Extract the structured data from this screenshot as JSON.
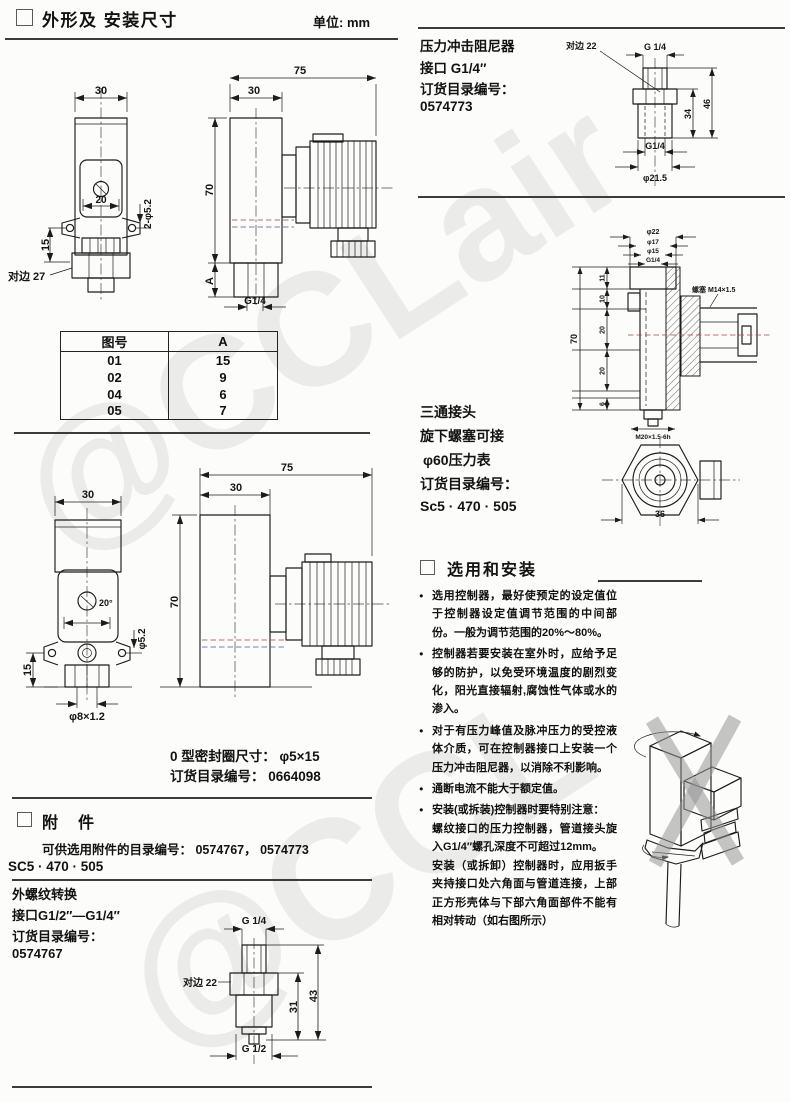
{
  "watermark": {
    "big": "@CCLair",
    "bottom": "@CCL"
  },
  "left": {
    "header": {
      "title": "外形及 安装尺寸",
      "unit": "单位: mm"
    },
    "drawing1": {
      "front": {
        "w30": "30",
        "w20": "20",
        "h15": "15",
        "holes": "2-φ5.2",
        "flats": "对边 27"
      },
      "side": {
        "w75": "75",
        "w30": "30",
        "h70": "70",
        "hA": "A",
        "thread": "G1/4"
      }
    },
    "table": {
      "col_no": "图号",
      "col_a": "A",
      "rows": [
        {
          "no": "01",
          "a": "15"
        },
        {
          "no": "02",
          "a": "9"
        },
        {
          "no": "04",
          "a": "6"
        },
        {
          "no": "05",
          "a": "7"
        }
      ]
    },
    "drawing2": {
      "front": {
        "w30": "30",
        "w20": "20°",
        "h15": "15",
        "hole": "φ5.2",
        "gland": "φ8×1.2"
      },
      "side": {
        "w75": "75",
        "w30": "30",
        "h70": "70"
      }
    },
    "oring": {
      "line1": "0 型密封圈尺寸： φ5×15",
      "line2": "订货目录编号： 0664098"
    },
    "accessories": {
      "title": "附　件",
      "catalog": "可供选用附件的目录编号： 0574767， 0574773",
      "model": "SC5 · 470 · 505",
      "adapter": {
        "line1": "外螺纹转换",
        "line2": "接口G1/2″—G1/4″",
        "line3": "订货目录编号：",
        "line4": "0574767",
        "dims": {
          "top": "G 1/4",
          "flats": "对边 22",
          "h31": "31",
          "h43": "43",
          "bottom": "G 1/2"
        }
      }
    }
  },
  "right": {
    "damper": {
      "line1": "压力冲击阻尼器",
      "line2": "接口 G1/4″",
      "line3": "订货目录编号：",
      "line4": "0574773",
      "dims": {
        "flats": "对边 22",
        "top": "G 1/4",
        "h34": "34",
        "h46": "46",
        "thread": "G1/4",
        "dia": "φ21.5"
      }
    },
    "tee": {
      "line1": "三通接头",
      "line2": "旋下螺塞可接",
      "line3": "φ60压力表",
      "line4": "订货目录编号：",
      "line5": "Sc5 · 470 · 505",
      "dims": {
        "d22": "φ22",
        "d17": "φ17",
        "d15": "φ15",
        "g14": "G1/4",
        "s11": "11",
        "s10": "10",
        "s20a": "20",
        "s20b": "20",
        "s6": "6",
        "h70": "70",
        "plug": "螺塞 M14×1.5",
        "thread": "M20×1.5-6h",
        "w36": "36"
      }
    },
    "selection": {
      "title": "选用和安装",
      "bullets": [
        {
          "text": "选用控制器，最好使预定的设定值位于控制器设定值调节范围的中间部份。一般为调节范围的20%～80%。"
        },
        {
          "text": "控制器若要安装在室外时，应给予足够的防护，以免受环境温度的剧烈变化，阳光直接辐射,腐蚀性气体或水的渗入。"
        },
        {
          "text": "对于有压力峰值及脉冲压力的受控液体介质，可在控制器接口上安装一个压力冲击阻尼器，以消除不利影响。"
        },
        {
          "text": "通断电流不能大于额定值。"
        },
        {
          "text": "安装(或拆装)控制器时要特别注意：",
          "sub1": "螺纹接口的压力控制器，管道接头旋入G1/4″螺孔深度不可超过12mm。",
          "sub2": "安装（或拆卸）控制器时，应用扳手夹持接口处六角面与管道连接，上部正方形壳体与下部六角面部件不能有相对转动（如右图所示）"
        }
      ]
    }
  }
}
